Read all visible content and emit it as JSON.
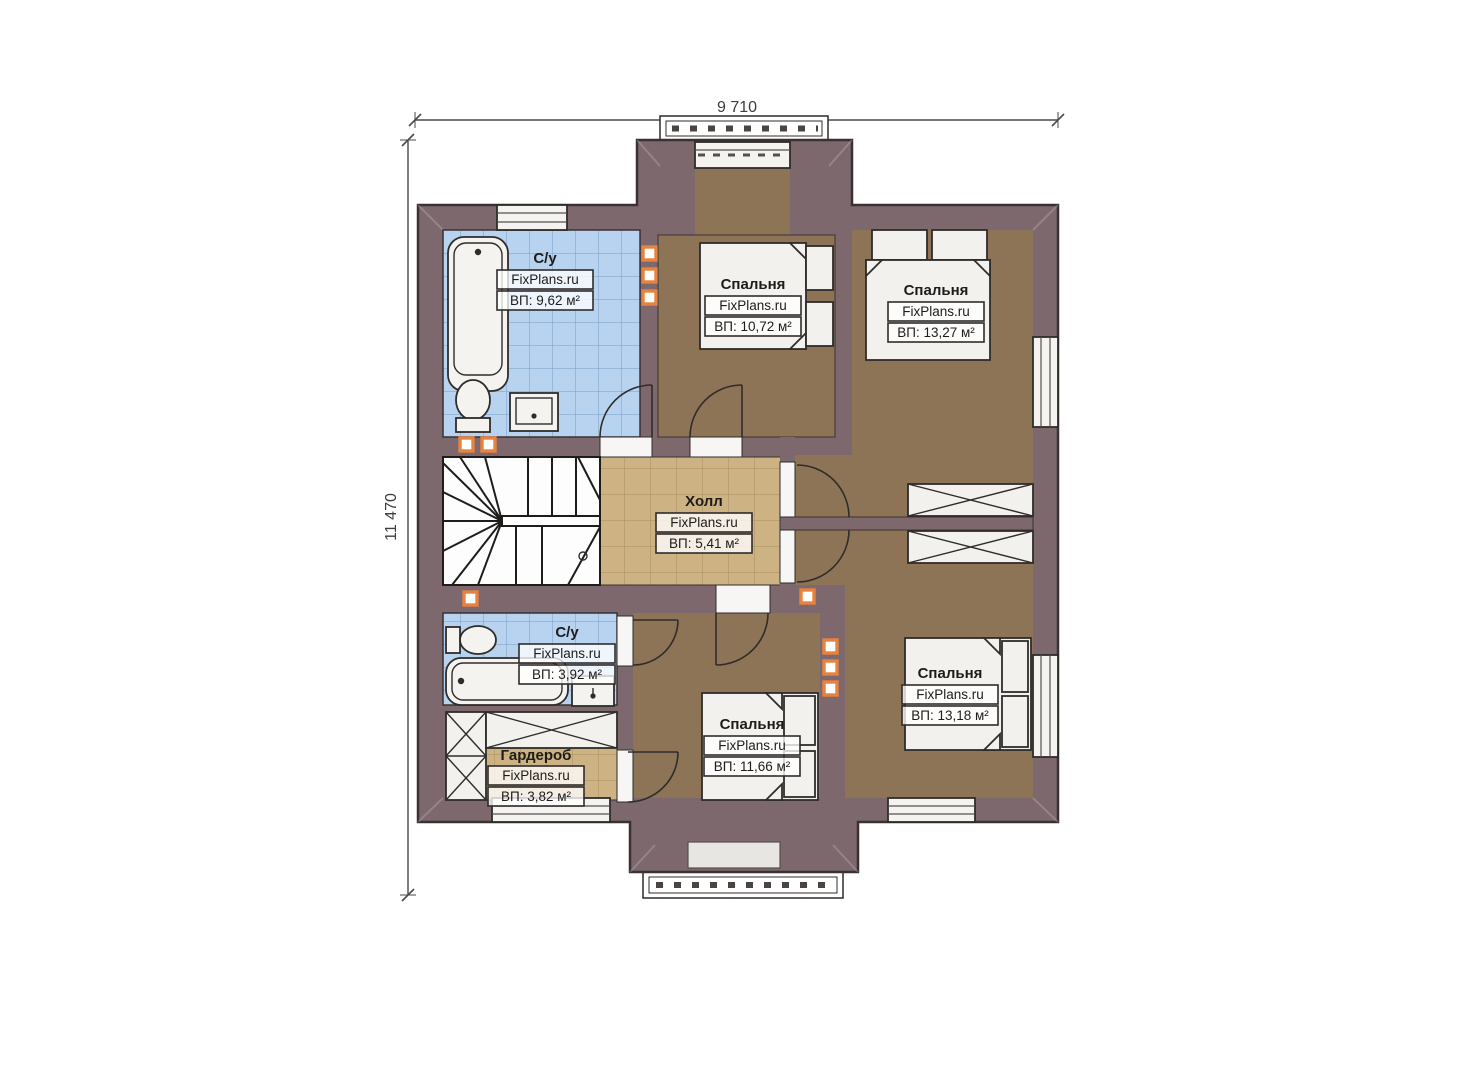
{
  "plan": {
    "dim_width": "9 710",
    "dim_height": "11 470",
    "watermark": "FixPlans.ru",
    "rooms": [
      {
        "id": "bath-top",
        "name": "С/у",
        "area": "ВП: 9,62 м²"
      },
      {
        "id": "bedroom-top-middle",
        "name": "Спальня",
        "area": "ВП: 10,72 м²"
      },
      {
        "id": "bedroom-top-right",
        "name": "Спальня",
        "area": "ВП: 13,27 м²"
      },
      {
        "id": "hall",
        "name": "Холл",
        "area": "ВП: 5,41 м²"
      },
      {
        "id": "bath-bottom",
        "name": "С/у",
        "area": "ВП: 3,92 м²"
      },
      {
        "id": "wardrobe",
        "name": "Гардероб",
        "area": "ВП: 3,82 м²"
      },
      {
        "id": "bedroom-bottom-middle",
        "name": "Спальня",
        "area": "ВП: 11,66 м²"
      },
      {
        "id": "bedroom-bottom-right",
        "name": "Спальня",
        "area": "ВП: 13,18 м²"
      }
    ],
    "colors": {
      "wall": "#7d696d",
      "wall_outline": "#3a3132",
      "room_floor": "#8d7457",
      "hall_floor": "#cdb283",
      "bath_floor": "#b7d3ef",
      "alcove": "#e7e6e3",
      "marker_orange": "#e8823f"
    }
  }
}
